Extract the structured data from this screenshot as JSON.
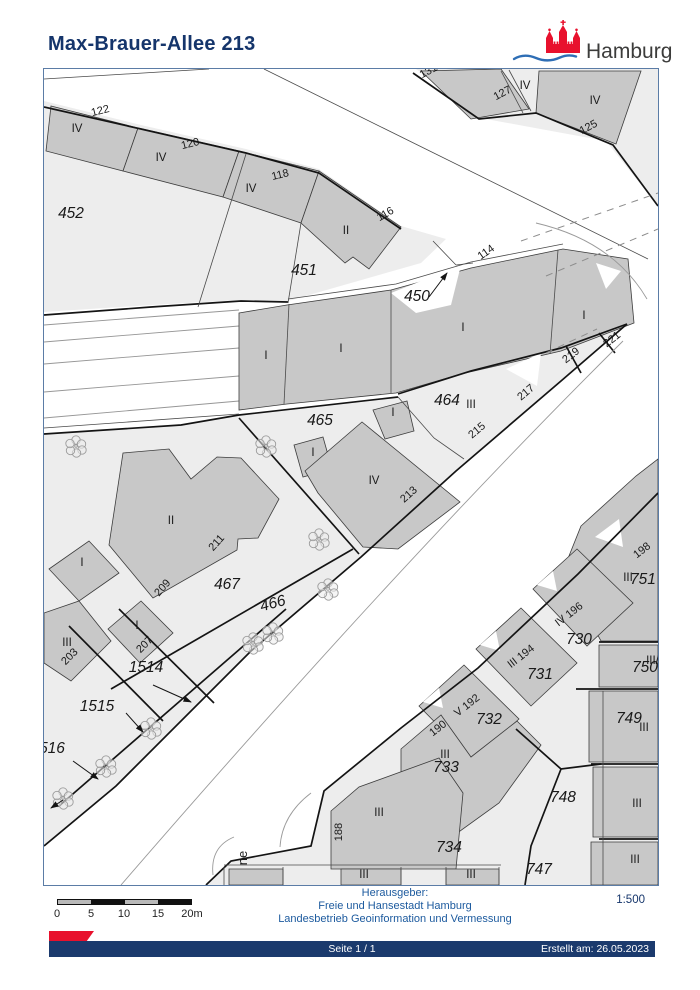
{
  "header": {
    "title": "Max-Brauer-Allee 213",
    "logo_text": "Hamburg"
  },
  "footer": {
    "publisher_line1": "Herausgeber:",
    "publisher_line2": "Freie und Hansestadt Hamburg",
    "publisher_line3": "Landesbetrieb Geoinformation und Vermessung",
    "scale_ratio": "1:500",
    "page_text": "Seite 1 / 1",
    "created_text": "Erstellt am: 26.05.2023",
    "scalebar_labels": [
      "0",
      "5",
      "10",
      "15",
      "20m"
    ],
    "scalebar_positions": [
      57,
      91,
      124,
      158,
      192
    ]
  },
  "colors": {
    "title_blue": "#15356b",
    "footer_blue": "#1c5a9e",
    "bar_navy": "#1b3a6d",
    "logo_red": "#e8112d",
    "wave_blue": "#2e6eb5",
    "land": "#ededed",
    "building": "#c8c8c8",
    "line_dark": "#141414"
  },
  "map": {
    "land": [
      "43,100 140,124 245,148 318,168 400,225 445,238 420,262 287,300 240,299 150,304 43,311",
      "415,68 485,118 605,140 657,205 657,68",
      "43,433 180,424 238,414 397,396 397,393 470,370 560,347 626,323 560,380 455,470 360,556 250,650 115,785 43,845",
      "657,492 577,573 477,667 400,727 323,790 310,845 230,860 205,884 657,884",
      "223,864 500,864 500,884 223,884"
    ],
    "lanes": [
      "43,324 238,309",
      "43,341 238,325",
      "43,363 238,347",
      "43,391 238,375",
      "43,417 238,400"
    ],
    "buildings": [
      "50,105 137,127 122,170 45,150",
      "137,127 238,150 222,196 122,170",
      "238,150 318,170 300,222 222,196",
      "318,170 400,226 368,268 352,256 344,262 300,222",
      "420,70 500,68 528,108 470,118",
      "538,70 640,70 615,143 535,112",
      "238,312 286,304 390,289 470,267 562,248 627,258 633,322 560,350 460,373 395,392 286,403 238,409",
      "293,444 322,436 331,468 302,476",
      "304,470 361,421 459,501 397,548 362,546 317,492",
      "372,409 406,400 413,430 384,438",
      "122,452 168,448 190,478 216,456 240,457 278,498 257,537 237,538 236,549 152,597 108,544",
      "48,568 88,540 118,572 78,600",
      "107,628 140,600 172,632 139,662",
      "43,612 78,600 110,640 70,680 43,662",
      "580,525 635,475 657,458 657,640 600,640 562,570",
      "532,588 576,548 632,602 586,645",
      "475,648 520,607 576,662 530,705",
      "418,705 463,664 518,718 472,760",
      "400,748 440,714 470,756 516,720 540,744 498,802 448,838 400,798",
      "330,810 358,786 438,757 462,792 455,868 330,868",
      "598,644 657,644 657,686 598,686",
      "588,690 657,690 657,761 588,761",
      "592,766 657,766 657,836 592,836",
      "590,841 657,841 657,884 590,884",
      "228,868 282,868 282,884 228,884",
      "340,868 400,868 400,884 340,884",
      "445,868 498,868 498,884 445,884"
    ],
    "white_patches": [
      "390,292 415,312 450,304 460,264",
      "595,262 620,270 605,288",
      "505,368 540,352 536,385",
      "594,536 618,518 622,546",
      "536,584 552,570 556,590",
      "479,644 495,630 499,650",
      "422,701 438,687 442,707"
    ],
    "thick_lines": [
      "43,106 140,128 245,152 318,172 400,228",
      "412,72 478,118 535,112 612,144 657,205",
      "43,314 150,306 240,300 287,301",
      "43,433 180,424 238,414 397,396",
      "397,393 470,370 560,347 626,323",
      "626,323 560,380 455,470 360,556 250,650 115,785 43,845",
      "657,492 577,573 477,667 400,727 323,790 310,845 230,860 205,884",
      "238,417 358,553",
      "110,688 352,548",
      "285,608 58,805",
      "68,625 162,720",
      "118,608 213,702",
      "598,641 657,641",
      "575,688 657,688",
      "590,763 657,763",
      "598,838 657,838",
      "515,728 560,768 600,763",
      "560,768 530,845 524,884",
      "565,345 580,372",
      "598,332 614,352"
    ],
    "thin_lines": [
      "245,153 197,306",
      "300,222 287,302",
      "287,298 395,283 470,261 562,243",
      "397,396 433,437 463,458",
      "43,427 238,413",
      "43,78 208,68",
      "263,68 647,258",
      "500,70 522,112",
      "508,69 530,110",
      "432,240 455,264",
      "455,264 472,262",
      "602,690 602,884",
      "223,864 500,864",
      "282,866 282,884",
      "400,866 400,884",
      "445,866 445,884",
      "498,866 498,884",
      "223,866 223,884",
      "288,303 283,403",
      "390,289 390,392",
      "557,249 549,353"
    ],
    "dashed_lines": [
      "520,240 657,192",
      "545,275 657,228",
      "545,352 596,328"
    ],
    "curves": [
      "M535,222 Q612,240 646,298",
      "M622,340 Q400,560 120,884",
      "M310,792 Q281,814 279,846",
      "M233,836 Q209,846 212,874"
    ],
    "trees": [
      [
        75,
        445
      ],
      [
        265,
        445
      ],
      [
        318,
        538
      ],
      [
        327,
        588
      ],
      [
        272,
        632
      ],
      [
        252,
        642
      ],
      [
        150,
        727
      ],
      [
        105,
        765
      ],
      [
        62,
        797
      ]
    ],
    "arrows": [
      [
        428,
        296,
        446,
        272
      ],
      [
        152,
        684,
        190,
        701
      ],
      [
        125,
        712,
        142,
        731
      ],
      [
        72,
        760,
        97,
        778
      ],
      [
        62,
        799,
        50,
        807
      ]
    ],
    "labels": {
      "parcel": [
        [
          "452",
          70,
          217,
          0
        ],
        [
          "451",
          303,
          274,
          0
        ],
        [
          "450",
          416,
          300,
          0
        ],
        [
          "465",
          319,
          424,
          0
        ],
        [
          "464",
          446,
          404,
          0
        ],
        [
          "466",
          273,
          607,
          -15
        ],
        [
          "467",
          226,
          588,
          0
        ],
        [
          "1514",
          145,
          671,
          0
        ],
        [
          "1515",
          96,
          710,
          0
        ],
        [
          "516",
          51,
          752,
          0
        ],
        [
          "730",
          578,
          643,
          0
        ],
        [
          "731",
          539,
          678,
          0
        ],
        [
          "732",
          488,
          723,
          0
        ],
        [
          "733",
          445,
          771,
          0
        ],
        [
          "734",
          448,
          851,
          0
        ],
        [
          "747",
          538,
          873,
          0
        ],
        [
          "748",
          562,
          801,
          0
        ],
        [
          "749",
          628,
          722,
          0
        ],
        [
          "750",
          644,
          671,
          0
        ],
        [
          "751",
          642,
          583,
          0
        ]
      ],
      "house": [
        [
          "122",
          100,
          113,
          -14
        ],
        [
          "120",
          190,
          146,
          -14
        ],
        [
          "118",
          280,
          177,
          -14
        ],
        [
          "116",
          386,
          216,
          -30
        ],
        [
          "114",
          487,
          254,
          -35
        ],
        [
          "131",
          429,
          73,
          -28
        ],
        [
          "127",
          503,
          95,
          -28
        ],
        [
          "125",
          589,
          129,
          -28
        ],
        [
          "221",
          613,
          341,
          -38
        ],
        [
          "219",
          572,
          357,
          -38
        ],
        [
          "217",
          527,
          394,
          -40
        ],
        [
          "215",
          478,
          432,
          -40
        ],
        [
          "213",
          410,
          496,
          -42
        ],
        [
          "211",
          218,
          544,
          -48
        ],
        [
          "209",
          164,
          589,
          -48
        ],
        [
          "207",
          146,
          646,
          -45
        ],
        [
          "203",
          71,
          658,
          -45
        ],
        [
          "198",
          643,
          552,
          -38
        ],
        [
          "IV 196",
          570,
          616,
          -38
        ],
        [
          "III 194",
          522,
          658,
          -38
        ],
        [
          "V 192",
          468,
          707,
          -38
        ],
        [
          "190",
          439,
          730,
          -38
        ],
        [
          "188",
          341,
          831,
          -90
        ]
      ],
      "floor": [
        [
          "IV",
          76,
          131
        ],
        [
          "IV",
          160,
          160
        ],
        [
          "IV",
          250,
          191
        ],
        [
          "II",
          345,
          233
        ],
        [
          "IV",
          524,
          88
        ],
        [
          "IV",
          594,
          103
        ],
        [
          "I",
          265,
          358
        ],
        [
          "I",
          340,
          351
        ],
        [
          "I",
          462,
          330
        ],
        [
          "I",
          583,
          318
        ],
        [
          "III",
          470,
          407
        ],
        [
          "I",
          312,
          455
        ],
        [
          "I",
          392,
          415
        ],
        [
          "IV",
          373,
          483
        ],
        [
          "II",
          170,
          523
        ],
        [
          "I",
          81,
          565
        ],
        [
          "I",
          136,
          628
        ],
        [
          "III",
          66,
          645
        ],
        [
          "III",
          627,
          580
        ],
        [
          "III/-I",
          655,
          663
        ],
        [
          "III",
          643,
          730
        ],
        [
          "III",
          636,
          806
        ],
        [
          "III",
          634,
          862
        ],
        [
          "III",
          444,
          757
        ],
        [
          "III",
          378,
          815
        ],
        [
          "III",
          363,
          877
        ],
        [
          "III",
          470,
          877
        ]
      ],
      "street": [
        [
          "ne",
          246,
          857,
          -90
        ]
      ]
    }
  }
}
